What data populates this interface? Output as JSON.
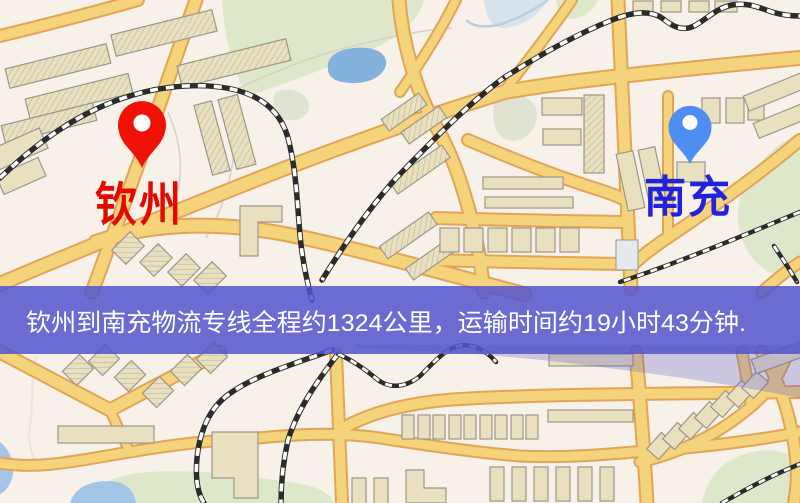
{
  "map": {
    "banner": {
      "text": "钦州到南充物流专线全程约1324公里，运输时间约19小时43分钟.",
      "distance_km": "1324",
      "duration_text": "19小时43分钟",
      "bg_color": "rgba(84,84,204,0.85)",
      "text_color": "#ffffff"
    },
    "markers": {
      "origin": {
        "label": "钦州",
        "pin_color": "#f01107",
        "label_color": "#e30b00"
      },
      "destination": {
        "label": "南充",
        "pin_color": "#4e8df2",
        "label_color": "#2222dd"
      }
    },
    "icons": {
      "origin_pin": "map-pin-icon",
      "destination_pin": "map-pin-icon"
    },
    "palette": {
      "background": "#f8f1e9",
      "road": "#f5d37a",
      "road_casing": "#e0a557",
      "building": "#e9e0c0",
      "building_outline": "#9d9788",
      "park": "#dde8cb",
      "water": "#85b2dc",
      "railway": "#2b2b2b"
    }
  }
}
